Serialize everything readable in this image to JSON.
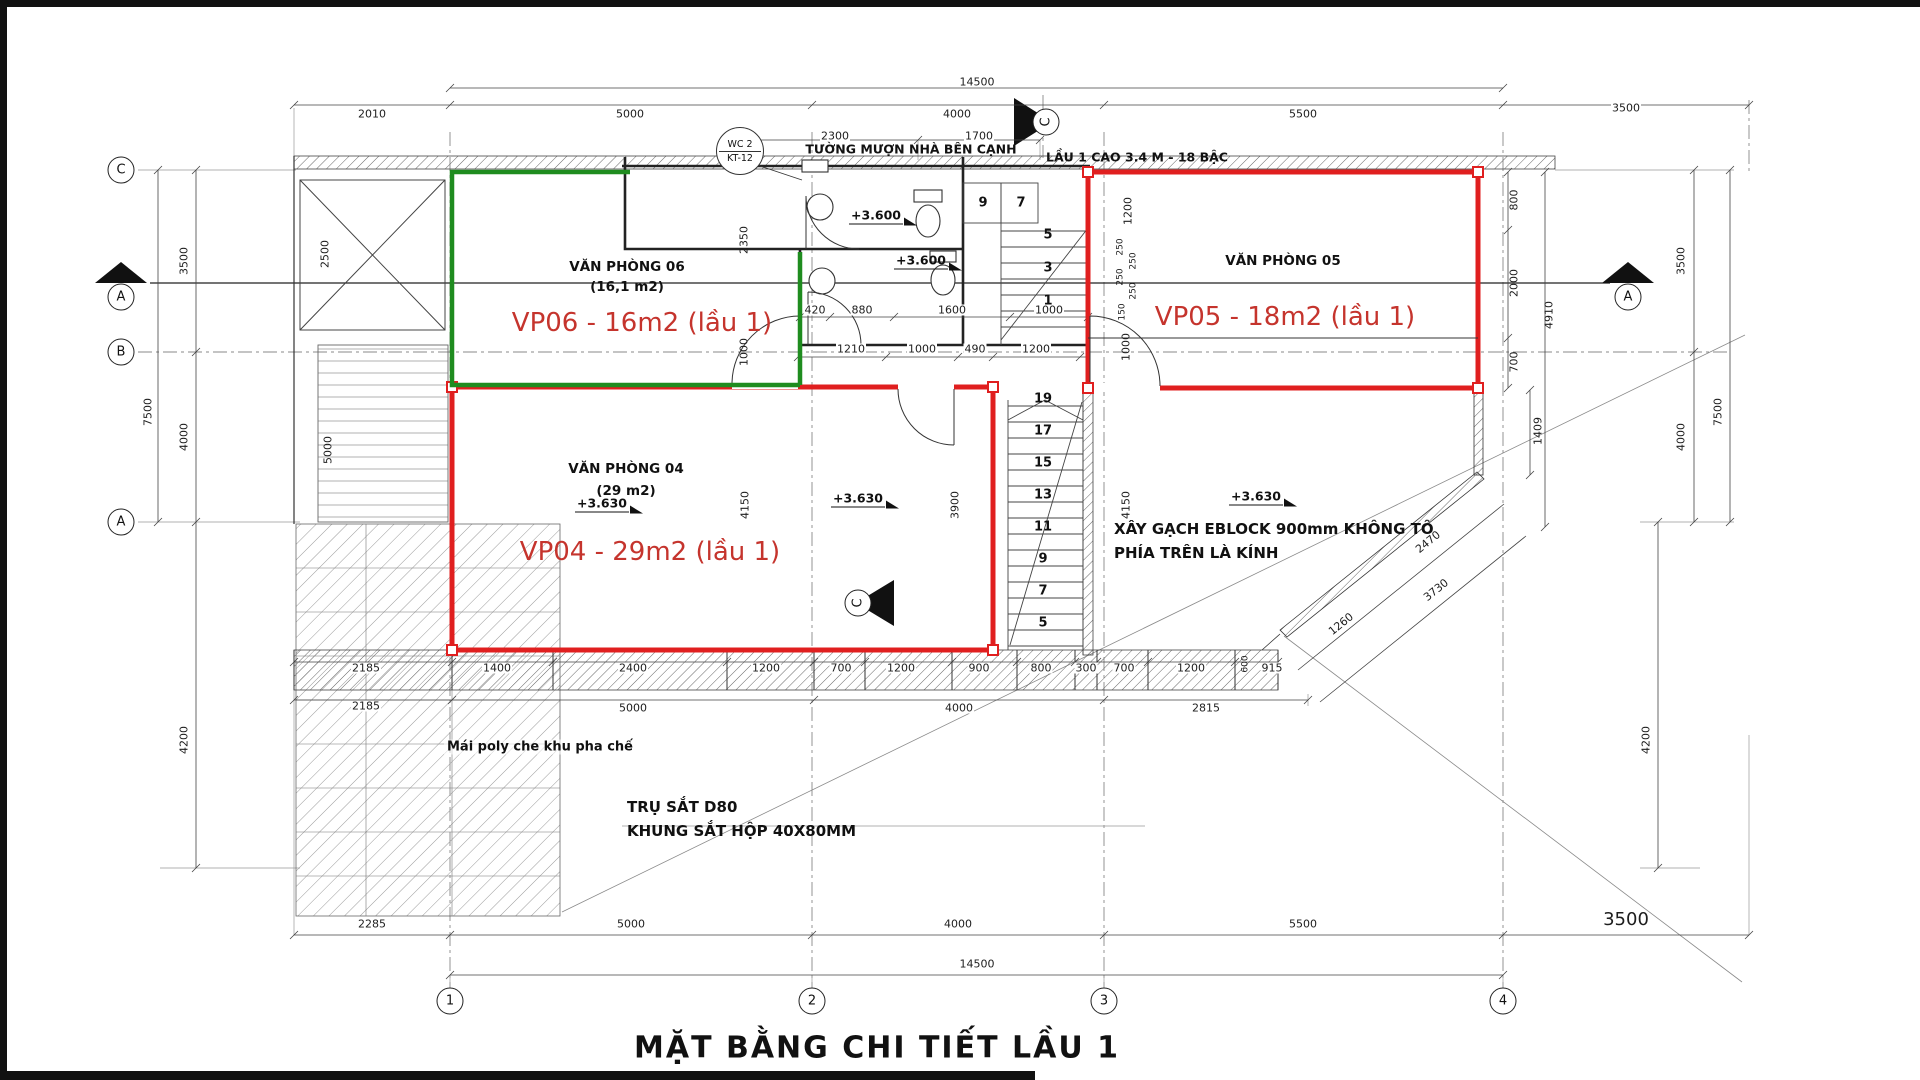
{
  "title": "MẶT BẰNG CHI TIẾT LẦU 1",
  "colors": {
    "wall_red": "#e01f1f",
    "room_green": "#1f8c1f",
    "tag_red": "#c5342d"
  },
  "callout": {
    "line1": "WC 2",
    "line2": "KT-12"
  },
  "notes": {
    "top_wall": "TƯỜNG MƯỢN NHÀ BÊN CẠNH",
    "floor": "LẦU 1 CAO 3.4 M - 18 BẬC",
    "eblock_1": "XÂY GẠCH EBLOCK 900mm KHÔNG TÔ",
    "eblock_2": "PHÍA TRÊN LÀ KÍNH",
    "mai_poly": "Mái poly che khu pha chế",
    "tru_sat": "TRỤ SẮT D80",
    "khung_sat": "KHUNG SẮT HỘP 40X80MM"
  },
  "rooms": {
    "vp06": {
      "name": "VĂN PHÒNG 06",
      "area": "(16,1 m2)",
      "tag": "VP06 - 16m2 (lầu 1)"
    },
    "vp04": {
      "name": "VĂN PHÒNG 04",
      "area": "(29 m2)",
      "tag": "VP04 - 29m2 (lầu 1)"
    },
    "vp05": {
      "name": "VĂN PHÒNG 05",
      "tag": "VP05 - 18m2 (lầu 1)"
    }
  },
  "levels": [
    {
      "t": "+3.600",
      "x": 876,
      "y": 216
    },
    {
      "t": "+3.600",
      "x": 921,
      "y": 261
    },
    {
      "t": "+3.630",
      "x": 602,
      "y": 504
    },
    {
      "t": "+3.630",
      "x": 858,
      "y": 499
    },
    {
      "t": "+3.630",
      "x": 1256,
      "y": 497
    }
  ],
  "grid": {
    "cols": [
      {
        "label": "1",
        "x": 450,
        "y": 1001
      },
      {
        "label": "2",
        "x": 812,
        "y": 1001
      },
      {
        "label": "3",
        "x": 1104,
        "y": 1001
      },
      {
        "label": "4",
        "x": 1503,
        "y": 1001
      }
    ],
    "rows": [
      {
        "label": "C",
        "x": 121,
        "y": 170
      },
      {
        "label": "B",
        "x": 121,
        "y": 352
      },
      {
        "label": "A",
        "x": 121,
        "y": 522
      }
    ],
    "sections": [
      {
        "label": "A",
        "x": 121,
        "y": 297
      },
      {
        "label": "A",
        "x": 1628,
        "y": 297
      }
    ],
    "flags": [
      {
        "label": "C",
        "x": 1046,
        "y": 122
      },
      {
        "label": "C",
        "x": 858,
        "y": 603
      }
    ]
  },
  "stairs": {
    "upper": [
      {
        "t": "9",
        "x": 983,
        "y": 203
      },
      {
        "t": "7",
        "x": 1021,
        "y": 203
      },
      {
        "t": "5",
        "x": 1048,
        "y": 235
      },
      {
        "t": "3",
        "x": 1048,
        "y": 268
      },
      {
        "t": "1",
        "x": 1048,
        "y": 301
      }
    ],
    "lower": [
      {
        "t": "19",
        "x": 1043,
        "y": 399
      },
      {
        "t": "17",
        "x": 1043,
        "y": 431
      },
      {
        "t": "15",
        "x": 1043,
        "y": 463
      },
      {
        "t": "13",
        "x": 1043,
        "y": 495
      },
      {
        "t": "11",
        "x": 1043,
        "y": 527
      },
      {
        "t": "9",
        "x": 1043,
        "y": 559
      },
      {
        "t": "7",
        "x": 1043,
        "y": 591
      },
      {
        "t": "5",
        "x": 1043,
        "y": 623
      }
    ]
  },
  "dim_labels": [
    {
      "t": "14500",
      "x": 977,
      "y": 82
    },
    {
      "t": "2010",
      "x": 372,
      "y": 114
    },
    {
      "t": "5000",
      "x": 630,
      "y": 114
    },
    {
      "t": "4000",
      "x": 957,
      "y": 114
    },
    {
      "t": "5500",
      "x": 1303,
      "y": 114
    },
    {
      "t": "3500",
      "x": 1626,
      "y": 108
    },
    {
      "t": "2300",
      "x": 835,
      "y": 136
    },
    {
      "t": "1700",
      "x": 979,
      "y": 136
    },
    {
      "t": "420",
      "x": 815,
      "y": 310
    },
    {
      "t": "880",
      "x": 862,
      "y": 310
    },
    {
      "t": "1600",
      "x": 952,
      "y": 310
    },
    {
      "t": "1000",
      "x": 1049,
      "y": 310
    },
    {
      "t": "1210",
      "x": 851,
      "y": 349
    },
    {
      "t": "1000",
      "x": 922,
      "y": 349
    },
    {
      "t": "490",
      "x": 975,
      "y": 349
    },
    {
      "t": "1200",
      "x": 1036,
      "y": 349
    },
    {
      "t": "3500",
      "x": 184,
      "y": 261,
      "r": 90
    },
    {
      "t": "7500",
      "x": 148,
      "y": 412,
      "r": 90
    },
    {
      "t": "4000",
      "x": 184,
      "y": 437,
      "r": 90
    },
    {
      "t": "4200",
      "x": 184,
      "y": 740,
      "r": 90
    },
    {
      "t": "2500",
      "x": 325,
      "y": 254,
      "r": 90
    },
    {
      "t": "5000",
      "x": 328,
      "y": 450,
      "r": 90
    },
    {
      "t": "2350",
      "x": 744,
      "y": 240,
      "r": 90
    },
    {
      "t": "1000",
      "x": 744,
      "y": 352,
      "r": 90
    },
    {
      "t": "4150",
      "x": 745,
      "y": 505,
      "r": 90
    },
    {
      "t": "3900",
      "x": 955,
      "y": 505,
      "r": 90
    },
    {
      "t": "4150",
      "x": 1126,
      "y": 505,
      "r": 90
    },
    {
      "t": "1200",
      "x": 1128,
      "y": 211,
      "r": 90
    },
    {
      "t": "250",
      "x": 1121,
      "y": 247,
      "r": 90,
      "c": "xs"
    },
    {
      "t": "250",
      "x": 1134,
      "y": 261,
      "r": 90,
      "c": "xs"
    },
    {
      "t": "250",
      "x": 1121,
      "y": 277,
      "r": 90,
      "c": "xs"
    },
    {
      "t": "250",
      "x": 1134,
      "y": 291,
      "r": 90,
      "c": "xs"
    },
    {
      "t": "150",
      "x": 1123,
      "y": 312,
      "r": 90,
      "c": "xs"
    },
    {
      "t": "1000",
      "x": 1126,
      "y": 347,
      "r": 90
    },
    {
      "t": "800",
      "x": 1514,
      "y": 200,
      "r": 90
    },
    {
      "t": "2000",
      "x": 1514,
      "y": 283,
      "r": 90
    },
    {
      "t": "4910",
      "x": 1549,
      "y": 315,
      "r": 90
    },
    {
      "t": "700",
      "x": 1514,
      "y": 362,
      "r": 90
    },
    {
      "t": "1409",
      "x": 1538,
      "y": 431,
      "r": 90
    },
    {
      "t": "3500",
      "x": 1681,
      "y": 261,
      "r": 90
    },
    {
      "t": "7500",
      "x": 1718,
      "y": 412,
      "r": 90
    },
    {
      "t": "4000",
      "x": 1681,
      "y": 437,
      "r": 90
    },
    {
      "t": "4200",
      "x": 1646,
      "y": 740,
      "r": 90
    },
    {
      "t": "2470",
      "x": 1428,
      "y": 542,
      "r": -39
    },
    {
      "t": "3730",
      "x": 1436,
      "y": 590,
      "r": -39
    },
    {
      "t": "1260",
      "x": 1341,
      "y": 624,
      "r": -39
    },
    {
      "t": "2185",
      "x": 366,
      "y": 668
    },
    {
      "t": "1400",
      "x": 497,
      "y": 668
    },
    {
      "t": "2400",
      "x": 633,
      "y": 668
    },
    {
      "t": "1200",
      "x": 766,
      "y": 668
    },
    {
      "t": "700",
      "x": 841,
      "y": 668
    },
    {
      "t": "1200",
      "x": 901,
      "y": 668
    },
    {
      "t": "900",
      "x": 979,
      "y": 668
    },
    {
      "t": "800",
      "x": 1041,
      "y": 668
    },
    {
      "t": "300",
      "x": 1086,
      "y": 668
    },
    {
      "t": "700",
      "x": 1124,
      "y": 668
    },
    {
      "t": "1200",
      "x": 1191,
      "y": 668
    },
    {
      "t": "600",
      "x": 1246,
      "y": 664,
      "r": 90,
      "c": "xs"
    },
    {
      "t": "915",
      "x": 1272,
      "y": 668
    },
    {
      "t": "2185",
      "x": 366,
      "y": 706
    },
    {
      "t": "5000",
      "x": 633,
      "y": 708
    },
    {
      "t": "4000",
      "x": 959,
      "y": 708
    },
    {
      "t": "2815",
      "x": 1206,
      "y": 708
    },
    {
      "t": "2285",
      "x": 372,
      "y": 924
    },
    {
      "t": "5000",
      "x": 631,
      "y": 924
    },
    {
      "t": "4000",
      "x": 958,
      "y": 924
    },
    {
      "t": "5500",
      "x": 1303,
      "y": 924
    },
    {
      "t": "3500",
      "x": 1626,
      "y": 920,
      "c": "lg"
    },
    {
      "t": "14500",
      "x": 977,
      "y": 964
    }
  ]
}
